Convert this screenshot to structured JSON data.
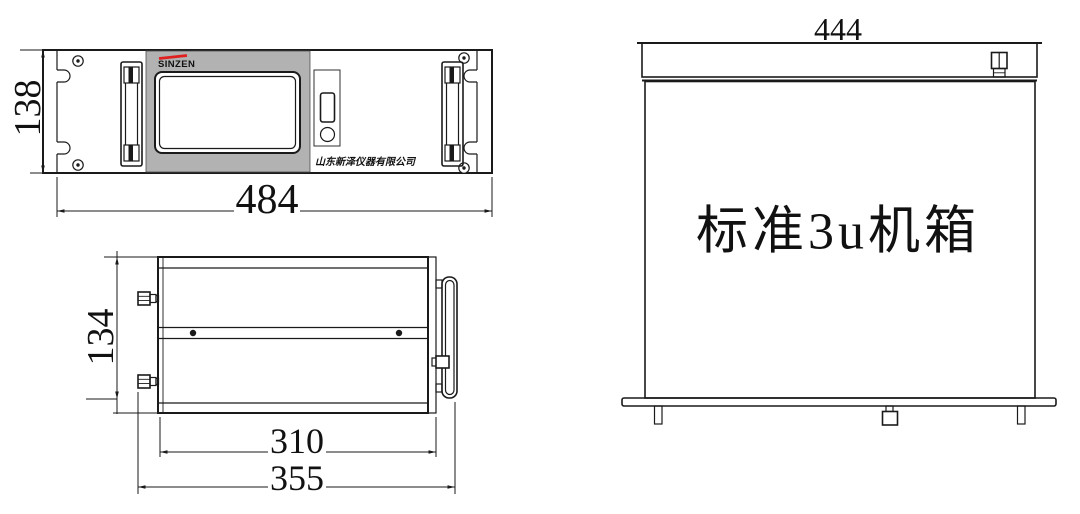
{
  "drawing": {
    "front_view": {
      "brand": "SINZEN",
      "company": "山东新泽仪器有限公司",
      "dim_width": "484",
      "dim_height": "138"
    },
    "top_view": {
      "dim_height": "134",
      "dim_body_depth": "310",
      "dim_overall_depth": "355"
    },
    "side_view": {
      "dim_width": "444",
      "caption": "标准3u机箱"
    },
    "colors": {
      "line": "#1a1a1a",
      "panel_gray": "#b2b2b2",
      "brand_red": "#e02020",
      "background": "#ffffff"
    }
  }
}
